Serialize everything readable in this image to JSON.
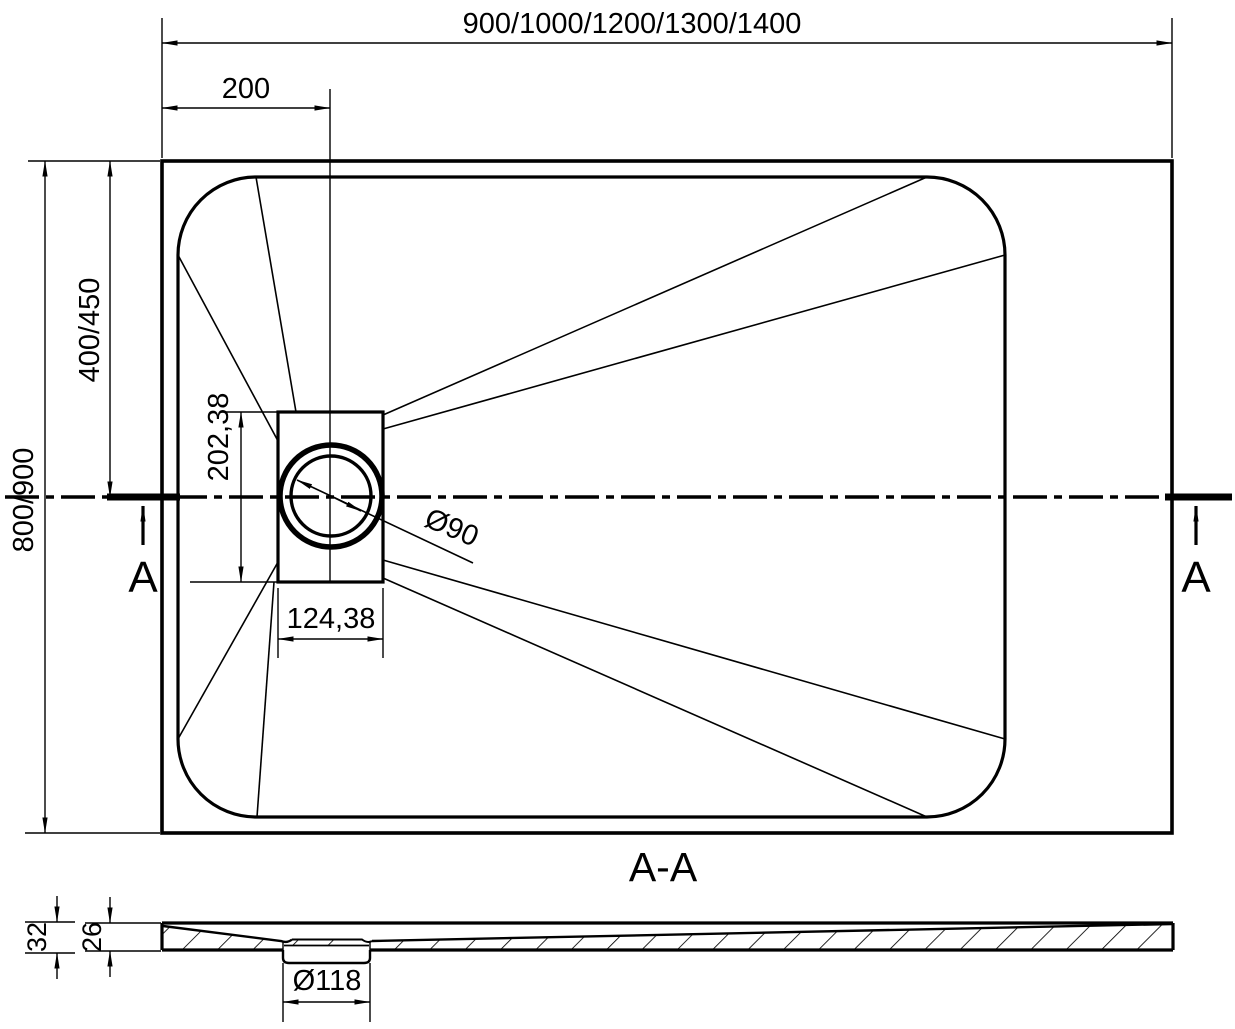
{
  "drawing": {
    "type": "technical-drawing-shower-tray",
    "section_title": "A-A",
    "section_marker": "A",
    "dims": {
      "overall_width": "900/1000/1200/1300/1400",
      "drain_offset_x": "200",
      "overall_depth": "800/900",
      "drain_offset_y": "400/450",
      "drain_recess_height": "202,38",
      "drain_recess_width": "124,38",
      "drain_diameter": "Ø90",
      "waste_hole_diameter": "Ø118",
      "tray_total_height": "32",
      "tray_inner_height": "26"
    },
    "colors": {
      "line": "#000000",
      "background": "#ffffff"
    }
  }
}
